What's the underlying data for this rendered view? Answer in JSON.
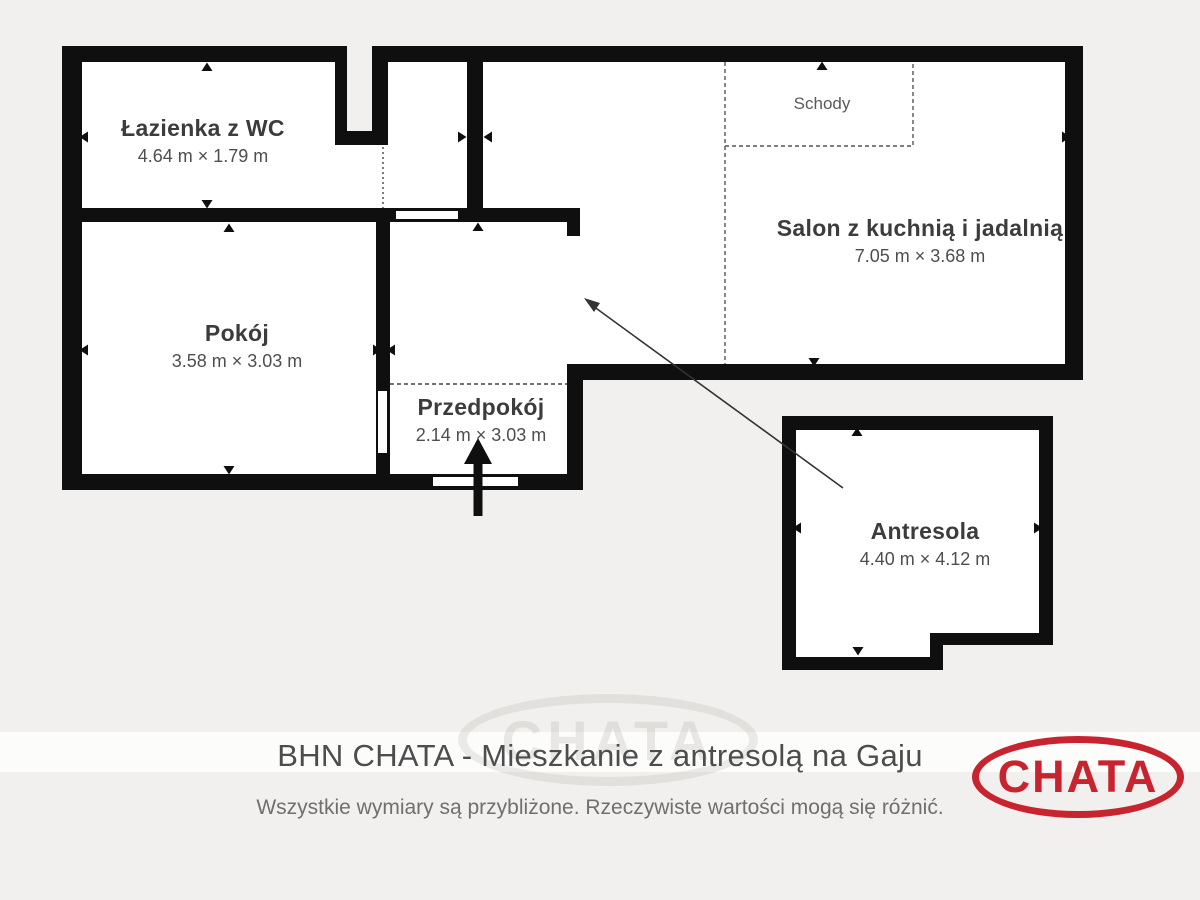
{
  "plan": {
    "rooms": {
      "lazienka": {
        "name": "Łazienka z WC",
        "dims": "4.64 m × 1.79 m"
      },
      "pokoj": {
        "name": "Pokój",
        "dims": "3.58 m × 3.03 m"
      },
      "przedpokoj": {
        "name": "Przedpokój",
        "dims": "2.14 m × 3.03 m"
      },
      "salon": {
        "name": "Salon z kuchnią i jadalnią",
        "dims": "7.05 m × 3.68 m"
      },
      "antresola": {
        "name": "Antresola",
        "dims": "4.40 m × 4.12 m"
      }
    },
    "stairs_label": "Schody"
  },
  "footer": {
    "title": "BHN CHATA - Mieszkanie z antresolą na Gaju",
    "disclaimer": "Wszystkie wymiary są przybliżone. Rzeczywiste wartości mogą się różnić.",
    "logo_text": "CHATA",
    "watermark_text": "CHATA"
  },
  "colors": {
    "background": "#f2f0ee",
    "wall": "#0f0f0f",
    "room_fill": "#ffffff",
    "label_text": "#3c3c3c",
    "dims_text": "#4e4e4e",
    "logo_red": "#c72430"
  }
}
